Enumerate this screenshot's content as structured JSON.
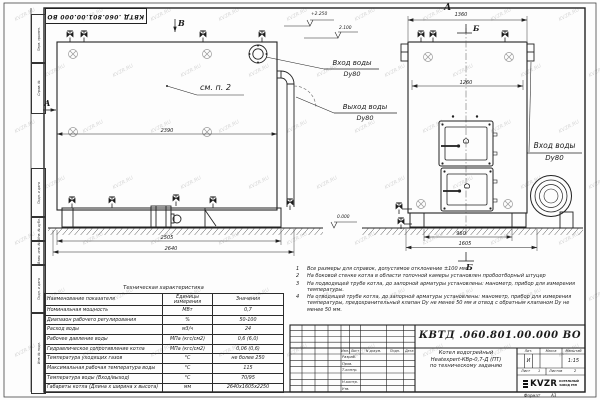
{
  "watermark": {
    "text": "KVZR.RU"
  },
  "stamp": {
    "doc_number_top": "КВТД .060.801.00.000 ВО"
  },
  "margin": {
    "labels": [
      "Перв. примен.",
      "Справ. №",
      "Подп. и дата",
      "Инв. № дубл.",
      "Взам. инв. №",
      "Подп. и дата",
      "Инв. № подл."
    ]
  },
  "side_view": {
    "view_label_b": "В",
    "section_label_a": "А",
    "ref_note": "см. п. 2",
    "dim_top": "2390",
    "dim_mid": "2505",
    "dim_bottom": "2640",
    "inlet_line1": "Вход воды",
    "inlet_line2": "Dy80",
    "outlet_line1": "Выход воды",
    "outlet_line2": "Dy80"
  },
  "front_view": {
    "view_label": "А",
    "dim_top": "1360",
    "section_label_top": "Б",
    "dim_inner": "1260",
    "inlet_line1": "Вход воды",
    "inlet_line2": "Dy80",
    "dim_base": "960",
    "dim_overall": "1605",
    "section_label_bottom": "Б"
  },
  "elevations": {
    "top": "+2.250",
    "mid": "2.100",
    "ground": "0.000"
  },
  "notes": {
    "items": [
      {
        "num": "1",
        "text": "Все размеры для справок, допустимое отклонение ±100 мм."
      },
      {
        "num": "2",
        "text": "На боковой стенке котла в области топочной камеры установлен пробоотборный штуцер"
      },
      {
        "num": "3",
        "text": "На подводящей трубе котла, до запорной арматуры установлены: манометр, прибор для измерения температуры."
      },
      {
        "num": "4",
        "text": "На отводящей трубе котла, до запорной арматуры установлены: манометр, прибор для измерения температуры, предохранительный клапан Dу не менее 50 мм и отвод с обратным клапаном Dу не менее 50 мм."
      }
    ]
  },
  "spec_table": {
    "title": "Техническая характеристика",
    "headers": [
      "Наименование показателя",
      "Единицы измерения",
      "Значения"
    ],
    "rows": [
      [
        "Номинальная мощность",
        "МВт",
        "0,7"
      ],
      [
        "Диапазон рабочего регулирования",
        "%",
        "50-100"
      ],
      [
        "Расход воды",
        "м3/ч",
        "24"
      ],
      [
        "Рабочее давление воды",
        "МПа (кгс/см2)",
        "0,6 (6,0)"
      ],
      [
        "Гидравлическое сопротивление котла",
        "МПа (кгс/см2)",
        "0,06 (0,6)"
      ],
      [
        "Температура уходящих газов",
        "°С",
        "не более 250"
      ],
      [
        "Максимальная рабочая температура воды",
        "°С",
        "115"
      ],
      [
        "Температура воды (Вход/выход)",
        "°С",
        "70/95"
      ],
      [
        "Габариты котла (Длина х ширина х высота)",
        "мм",
        "2640х1605х2250"
      ]
    ]
  },
  "title_block": {
    "doc_number": "КВТД .060.801.00.000 ВО",
    "name_line1": "Котел водогрейный",
    "name_line2": "Heatexpert-КВр-0,7-Д (ПТ)",
    "name_line3": "по техническому заданию",
    "header_cols": [
      "Изм.",
      "Лист",
      "N докум.",
      "Подп.",
      "Дата"
    ],
    "row_labels": [
      "Разраб.",
      "Пров.",
      "Т.контр.",
      "Н.контр.",
      "Утв."
    ],
    "lit_header": "Лит.",
    "mass_header": "Масса",
    "scale_header": "Масштаб",
    "lit_value": "И",
    "scale_value": "1:15",
    "sheet_label": "Лист",
    "sheet_value": "1",
    "sheets_label": "Листов",
    "sheets_value": "2",
    "logo_text": "KVZR",
    "company_line1": "КОТЕЛЬНЫЙ",
    "company_line2": "ЗАВОД РЭП",
    "format_label": "Формат",
    "format_value": "А3"
  }
}
